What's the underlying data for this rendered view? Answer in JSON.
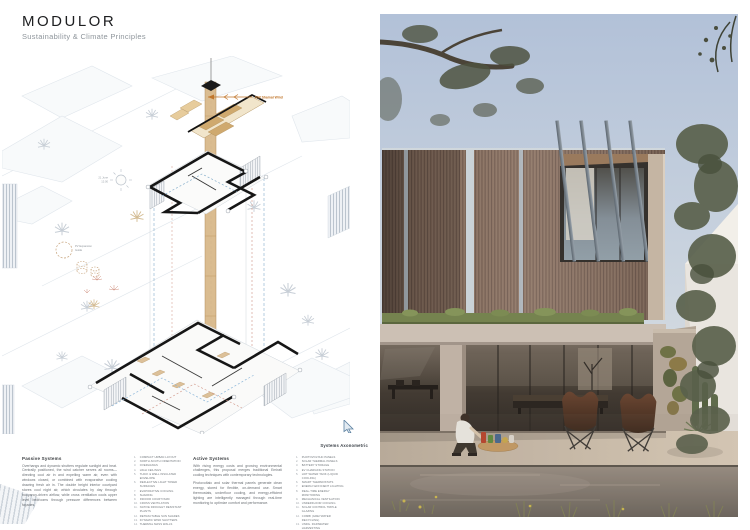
{
  "header": {
    "title": "MODULOR",
    "subtitle": "Sustainability & Climate Principles"
  },
  "diagram": {
    "caption": "Systems Axonometric",
    "wind_label": "NW Shamal Wind",
    "sun_label_1": "21 June",
    "sun_label_2": "12:00",
    "pv_label_1": "PV Expansion",
    "pv_label_2": "Guide"
  },
  "passive": {
    "heading": "Passive Systems",
    "body": "Overhangs and dynamic shutters regulate sunlight and heat. Centrally positioned, the wind catcher serves all rooms—directing cool air in and expelling warm air, even with windows closed, or combined with evaporative cooling drawing fresh air in. The double height interior courtyard stores cool night air, which circulates by day through buoyancy-driven airflow, while cross ventilation cools upper level bedrooms through pressure differences between façades.",
    "items": [
      "Compact urban layout",
      "North-south orientation",
      "Overhangs",
      "High ceilings",
      "Thick & well insulated envelope",
      "Reflective light toned surfaces",
      "Evaporative cooling",
      "Shading",
      "Indoor courtyard",
      "Cross ventilation",
      "Native drought resistant plants",
      "Retractable sun shades",
      "Dynamic wind shutters",
      "Thermal mass walls"
    ]
  },
  "active": {
    "heading": "Active Systems",
    "body1": "With rising energy costs and growing environmental challenges, this proposal merges traditional Emirati cooling techniques with contemporary technologies.",
    "body2": "Photovoltaic and solar thermal panels generate clean energy, stored for flexible, on-demand use. Smart thermostats, underfloor cooling, and energy-efficient lighting are intelligently managed through real-time monitoring to optimize comfort and performance.",
    "items": [
      "Photovoltaic panels",
      "Solar thermal panels",
      "Battery storage",
      "EV charging station",
      "Hot water tank (liquid cooling)",
      "Smart thermostats",
      "Energy-efficient lighting",
      "Real-time energy monitoring",
      "Mechanical ventilation",
      "Underfloor cooling",
      "Solar control triple glazing",
      "Combi (greywater recycling)",
      "Undg. rainwater harvesting"
    ]
  },
  "photo_colors": {
    "sky": "#b7c4d8",
    "timber": "#8a7060",
    "concrete": "#ccc0b4",
    "foliage": "#545b45",
    "pool": "#6f6860",
    "wind_accent": "#c0762c"
  }
}
